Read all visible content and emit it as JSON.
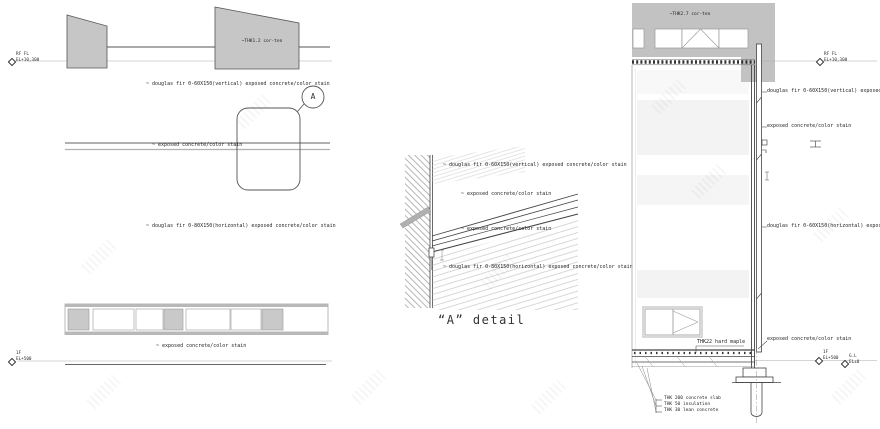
{
  "levels": {
    "rf": {
      "name": "RF FL",
      "elev": "EL+10,300"
    },
    "f1": {
      "name": "1F",
      "elev": "EL+500"
    },
    "gl": {
      "name": "G.L",
      "elev": "EL±0"
    }
  },
  "left": {
    "corten": "~THK1.2 cor-ten",
    "callout_letter": "A",
    "douglas_vertical": "~ douglas fir 0-60X150(vertical) exposed concrete/color stain",
    "exposed_upper": "~ exposed concrete/color stain",
    "douglas_horizontal": "~ douglas fir 0-80X150(horizontal) exposed concrete/color stain",
    "exposed_lower": "~ exposed concrete/color stain"
  },
  "detail": {
    "caption": "“A” detail",
    "douglas_vertical": "~ douglas fir 0-60X150(vertical) exposed concrete/color stain",
    "exposed_upper": "~ exposed concrete/color stain",
    "exposed_lower": "~ exposed concrete/color stain",
    "douglas_horizontal": "~ douglas fir 0-80X150(horizontal) exposed concrete/color stain"
  },
  "right": {
    "corten": "~THK2.7 cor-ten",
    "douglas_vertical": "douglas fir 0-60X150(vertical) exposed concrete/color stain",
    "exposed_upper": "exposed concrete/color stain",
    "douglas_horizontal": "douglas fir 0-60X150(horizontal) exposed concrete/color stain",
    "exposed_lower": "exposed concrete/color stain",
    "floor_finish": "THK22 hard maple",
    "slab_notes": [
      "THK 200 concrete slab",
      "THK 50 insulation",
      "THK 30 lean concrete"
    ]
  },
  "colors": {
    "fill_gray": "#c4c4c4",
    "line_dark": "#444444",
    "line_gray": "#9a9a9a"
  }
}
